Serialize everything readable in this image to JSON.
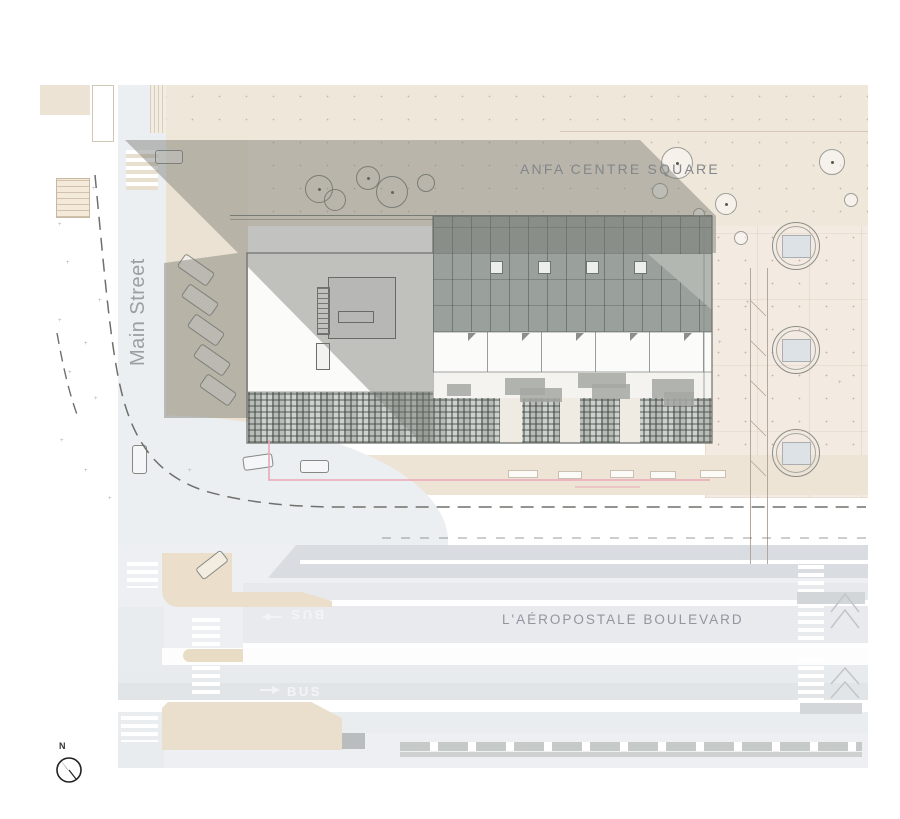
{
  "title": "Architectural site plan",
  "labels": {
    "square": "ANFA CENTRE SQUARE",
    "main_street": "Main Street",
    "boulevard": "L'AÉROPOSTALE BOULEVARD",
    "bus": "BUS",
    "north": "N"
  },
  "colors": {
    "plaza_beige": "#efe7da",
    "plaza_pink": "#f3eae1",
    "sidewalk_beige": "#eee4d6",
    "shadow_gray": "rgba(116,118,111,0.44)",
    "roof_gray": "#9aa09b",
    "road_gray": "#e2e5e8",
    "accent_pink": "#eaa7b8",
    "label_gray": "#83868a"
  }
}
